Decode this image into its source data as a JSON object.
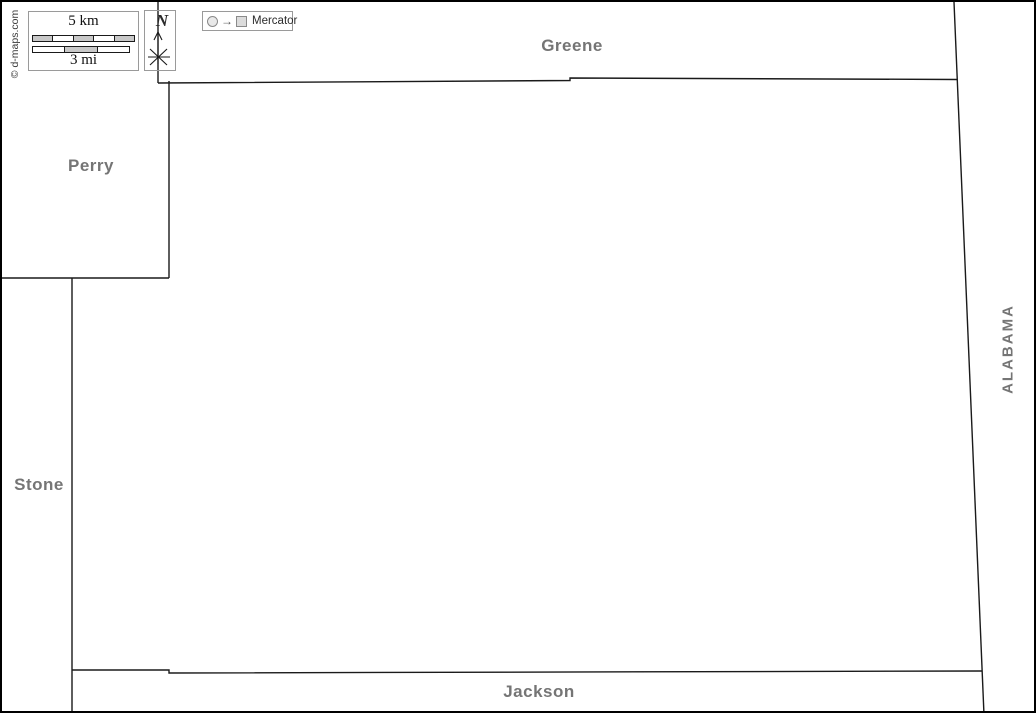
{
  "regions": {
    "greene": "Greene",
    "perry": "Perry",
    "stone": "Stone",
    "jackson": "Jackson",
    "alabama": "ALABAMA"
  },
  "scale_bar": {
    "km_label": "5 km",
    "mi_label": "3 mi",
    "km_segments": 5,
    "mi_segments": 3
  },
  "compass": {
    "north_label": "N",
    "icon": "compass-star-icon"
  },
  "projection": {
    "label": "Mercator",
    "arrow_glyph": "→",
    "icons": [
      "globe-circle-icon",
      "arrow-right-icon",
      "flat-map-square-icon"
    ]
  },
  "credit": {
    "text": "© d-maps.com"
  },
  "colors": {
    "label_gray": "#757575",
    "boundary_line": "#1a1a1a",
    "box_border": "#9a9a9a",
    "scale_bar_gray": "#c8c8c8",
    "frame": "#000000",
    "background": "#ffffff"
  }
}
